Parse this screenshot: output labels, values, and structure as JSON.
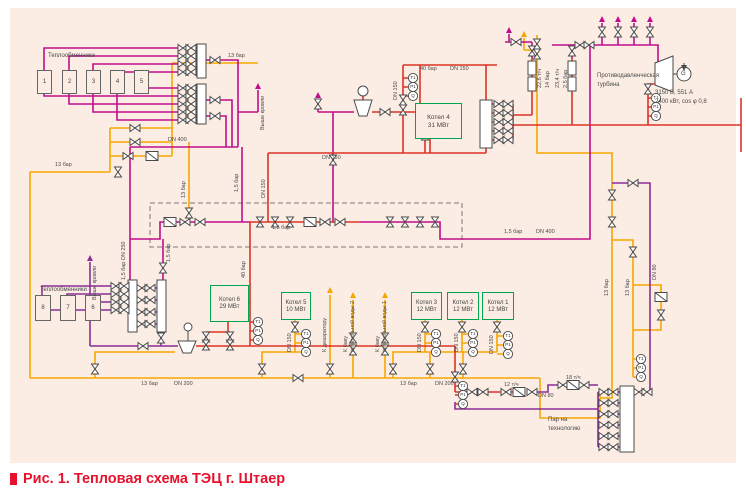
{
  "caption": {
    "text": "Рис. 1. Тепловая схема ТЭЦ г. Штаер"
  },
  "hx_top": {
    "title": "Теплообменники",
    "units": [
      "1",
      "2",
      "3",
      "4",
      "5"
    ]
  },
  "hx_left": {
    "title": "Теплообменники",
    "units": [
      "8",
      "7",
      "6"
    ]
  },
  "boilers": {
    "k4": {
      "name": "Котел 4",
      "power": "31 МВт"
    },
    "k6": {
      "name": "Котел 6",
      "power": "29 МВт"
    },
    "k5": {
      "name": "Котел 5",
      "power": "10 МВт"
    },
    "k3": {
      "name": "Котел 3",
      "power": "12 МВт"
    },
    "k2": {
      "name": "Котел 2",
      "power": "12 МВт"
    },
    "k1": {
      "name": "Котел 1",
      "power": "12 МВт"
    }
  },
  "turbine": {
    "label_line1": "Противодавленческая",
    "label_line2": "турбина",
    "generator": "G",
    "specs_line1": "3150 В, 551 А",
    "specs_line2": "2400 кВт, cos φ 0,8"
  },
  "gauges": {
    "t": "Т1",
    "p": "Р1",
    "q": "Q"
  },
  "pipe_labels": {
    "bar13": "13 бар",
    "bar15": "1,5 бар",
    "bar15dn250": "1,5 бар  DN 250",
    "bar40": "40 бар",
    "bar14": "14 бар",
    "bar25": "2,5 бар",
    "t226": "22,6 т/ч",
    "t234": "23,4 т/ч",
    "t12": "12 т/ч",
    "t18": "18 т/ч",
    "dn400": "DN 400",
    "dn250": "DN 250",
    "dn200": "DN 200",
    "dn150": "DN 150",
    "dn80": "DN 80"
  },
  "flow_labels": {
    "above_roof": "Выше кровли",
    "to_deaerator": "К деаэратору",
    "feed_tank2_l1": "К баку",
    "feed_tank2_l2": "питательной воды 2",
    "feed_tank1_l1": "К баку",
    "feed_tank1_l2": "питательной воды 1",
    "steam_l1": "Пар на",
    "steam_l2": "технологию"
  },
  "colors": {
    "orange": "#f7a600",
    "magenta": "#c00e8c",
    "purple": "#8c2d97",
    "red": "#dd3327",
    "green": "#00a551",
    "caption_red": "#e8112d",
    "background": "#fbede4"
  }
}
